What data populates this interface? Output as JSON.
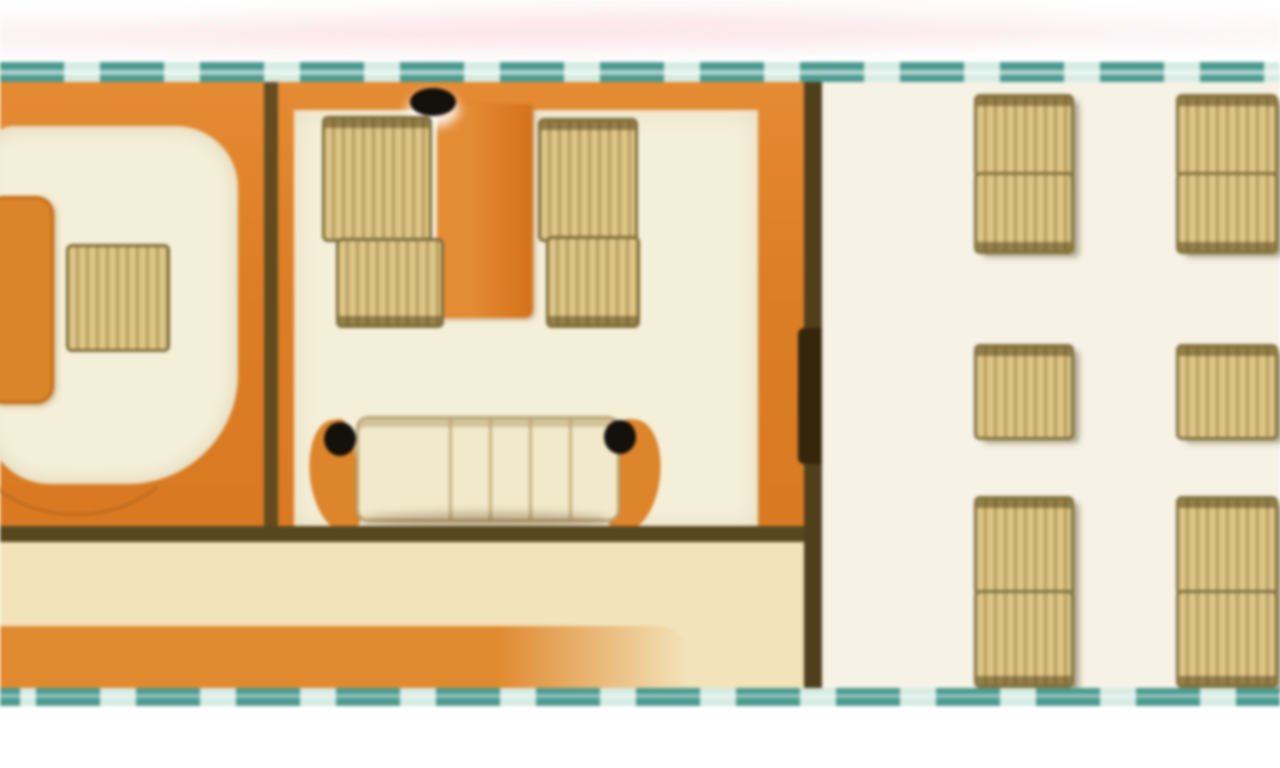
{
  "page": {
    "description": "Top-view interior deck floor plan strip bounded by dashed teal hull lines, on a white background"
  },
  "colors": {
    "orange-floor": "#dd8530",
    "orange-deep": "#c9701e",
    "table-orange-light": "#e18c38",
    "table-orange-dark": "#d2731f",
    "teal-dash": "#4e9a90",
    "teal-gap": "#d6ebe3",
    "cream-room": "#f4efda",
    "cream-lounge": "#f7f2e6",
    "beige-corridor": "#f2e3bc",
    "wall-dark": "#564721",
    "wall-door": "#33250c",
    "chair-tan": "#dcc68a",
    "chair-border": "#7c6b38",
    "chair-stripe": "#826428",
    "sofa-cream": "#f1e9ca",
    "sofa-border": "#b9a477",
    "rug-cream": "#f4efd9",
    "dot-black": "#14100c",
    "page-bg": "#ffffff"
  },
  "plan": {
    "hull": {
      "outline_style": "dashed",
      "outline_color": "#4e9a90"
    },
    "rooms": [
      {
        "name": "office-cabin",
        "floor": "orange wood",
        "furniture": [
          {
            "item": "desk",
            "count": 1
          },
          {
            "item": "desk-chair",
            "count": 1
          },
          {
            "item": "rug",
            "count": 1
          },
          {
            "item": "door-swing-arc",
            "count": 1
          }
        ]
      },
      {
        "name": "dining-cabin",
        "floor": "orange wood with cream rug",
        "furniture": [
          {
            "item": "center-table",
            "count": 1
          },
          {
            "item": "black-oval-fixture",
            "count": 3
          },
          {
            "item": "dining-chair",
            "count": 4
          },
          {
            "item": "sofa",
            "count": 1
          },
          {
            "item": "sofa-armrest",
            "count": 2
          }
        ]
      },
      {
        "name": "corridor",
        "floor": "beige with orange band",
        "furniture": []
      },
      {
        "name": "open-lounge",
        "floor": "cream",
        "furniture": [
          {
            "item": "club-chair-facing-pair",
            "count": 4
          },
          {
            "item": "club-chair-single",
            "count": 2
          }
        ]
      }
    ]
  }
}
